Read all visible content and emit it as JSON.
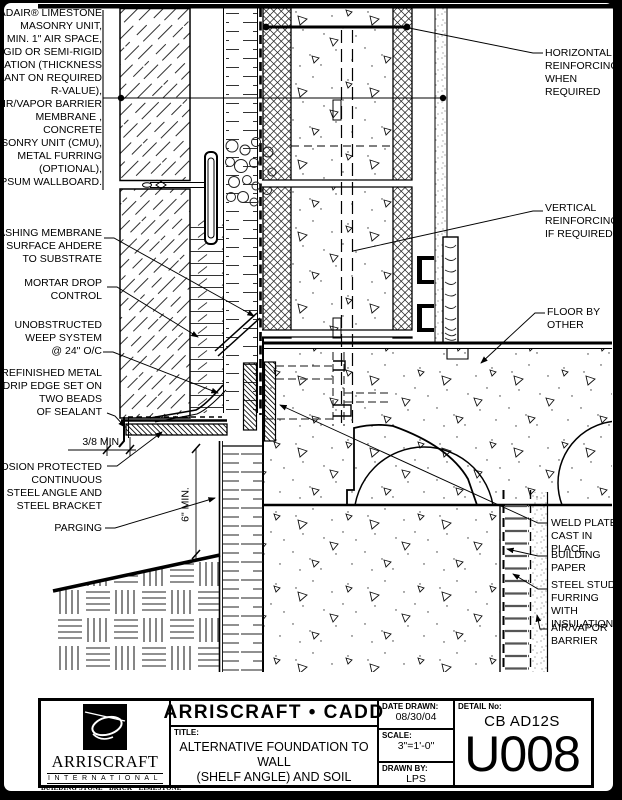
{
  "colors": {
    "ink": "#000000",
    "paper": "#ffffff"
  },
  "callouts": {
    "materials_note": "ADAIR® LIMESTONE\nMASONRY UNIT,\nMIN. 1\" AIR SPACE,\nRIGID OR SEMI-RIGID\nINSULATION (THICKNESS\nDEPENDANT ON REQUIRED\nR-VALUE),\nAIR/VAPOR BARRIER\nMEMBRANE ,\nCONCRETE\nMASONRY UNIT (CMU),\nMETAL FURRING\n(OPTIONAL),\nGYPSUM WALLBOARD.",
    "flashing": "FLASHING MEMBRANE\nSURFACE AHDERE\nTO SUBSTRATE",
    "mortar_drop": "MORTAR DROP\nCONTROL",
    "weep": "UNOBSTRUCTED\nWEEP SYSTEM\n@ 24\" O/C",
    "drip_edge": "PREFINISHED METAL\nDRIP EDGE SET ON\nTWO BEADS\nOF SEALANT",
    "dim_gap": "3/8 MIN.",
    "steel_angle": "CORROSION PROTECTED\nCONTINUOUS\nSTEEL ANGLE AND\nSTEEL BRACKET",
    "parging": "PARGING",
    "dim_height": "6\" MIN.",
    "horiz_reinf": "HORIZONTAL\nREINFORCING\nWHEN REQUIRED",
    "vert_reinf": "VERTICAL\nREINFORCING\nIF REQUIRED",
    "floor": "FLOOR BY\nOTHER",
    "weld_plate": "WELD PLATE\nCAST IN PLACE",
    "building_paper": "BUILDING\nPAPER",
    "steel_stud": "STEEL STUD\nFURRING WITH\nINSULATION",
    "avb": "AIR/VAPOR\nBARRIER"
  },
  "title_block": {
    "brand_title": "ARRISCRAFT • CADD",
    "title_label": "TITLE:",
    "title_line1": "ALTERNATIVE FOUNDATION TO WALL",
    "title_line2": "(SHELF ANGLE) AND SOIL",
    "date_label": "DATE DRAWN:",
    "date_value": "08/30/04",
    "scale_label": "SCALE:",
    "scale_value": "3\"=1'-0\"",
    "drawn_label": "DRAWN BY:",
    "drawn_value": "LPS",
    "detail_label": "DETAIL No:",
    "detail_code": "CB AD12S",
    "detail_number": "U008",
    "logo_name": "ARRISCRAFT",
    "logo_subtitle": "INTERNATIONAL",
    "logo_tagline": "BUILDING STONE · BRICK · LIMESTONE"
  }
}
